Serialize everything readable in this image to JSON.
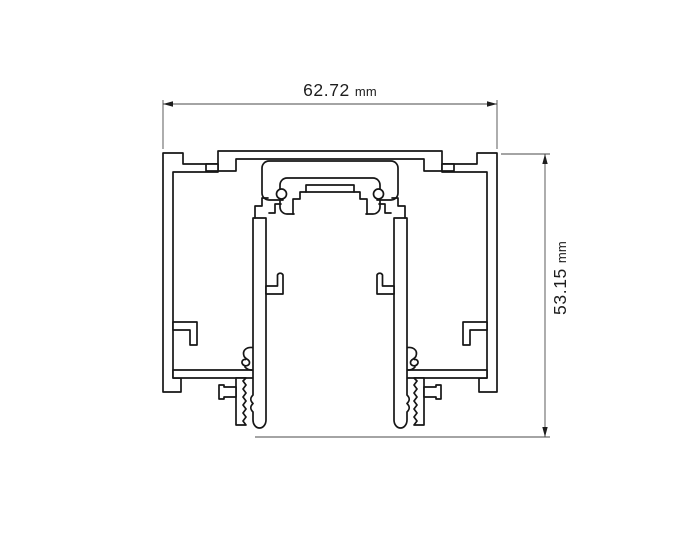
{
  "page": {
    "background": "#ffffff",
    "title": "Aluminum profile cross-section technical drawing"
  },
  "drawing": {
    "type": "technical-drawing-cross-section",
    "subject": "extruded aluminum track profile",
    "line_color": "#161616",
    "dimension_line_color": "#4a4a4a",
    "text_color": "#1d1d1d",
    "dimensions": {
      "width": {
        "value": "62.72",
        "unit": "mm",
        "orientation": "horizontal",
        "position": "top"
      },
      "height": {
        "value": "53.15",
        "unit": "mm",
        "orientation": "vertical",
        "position": "right"
      }
    }
  }
}
